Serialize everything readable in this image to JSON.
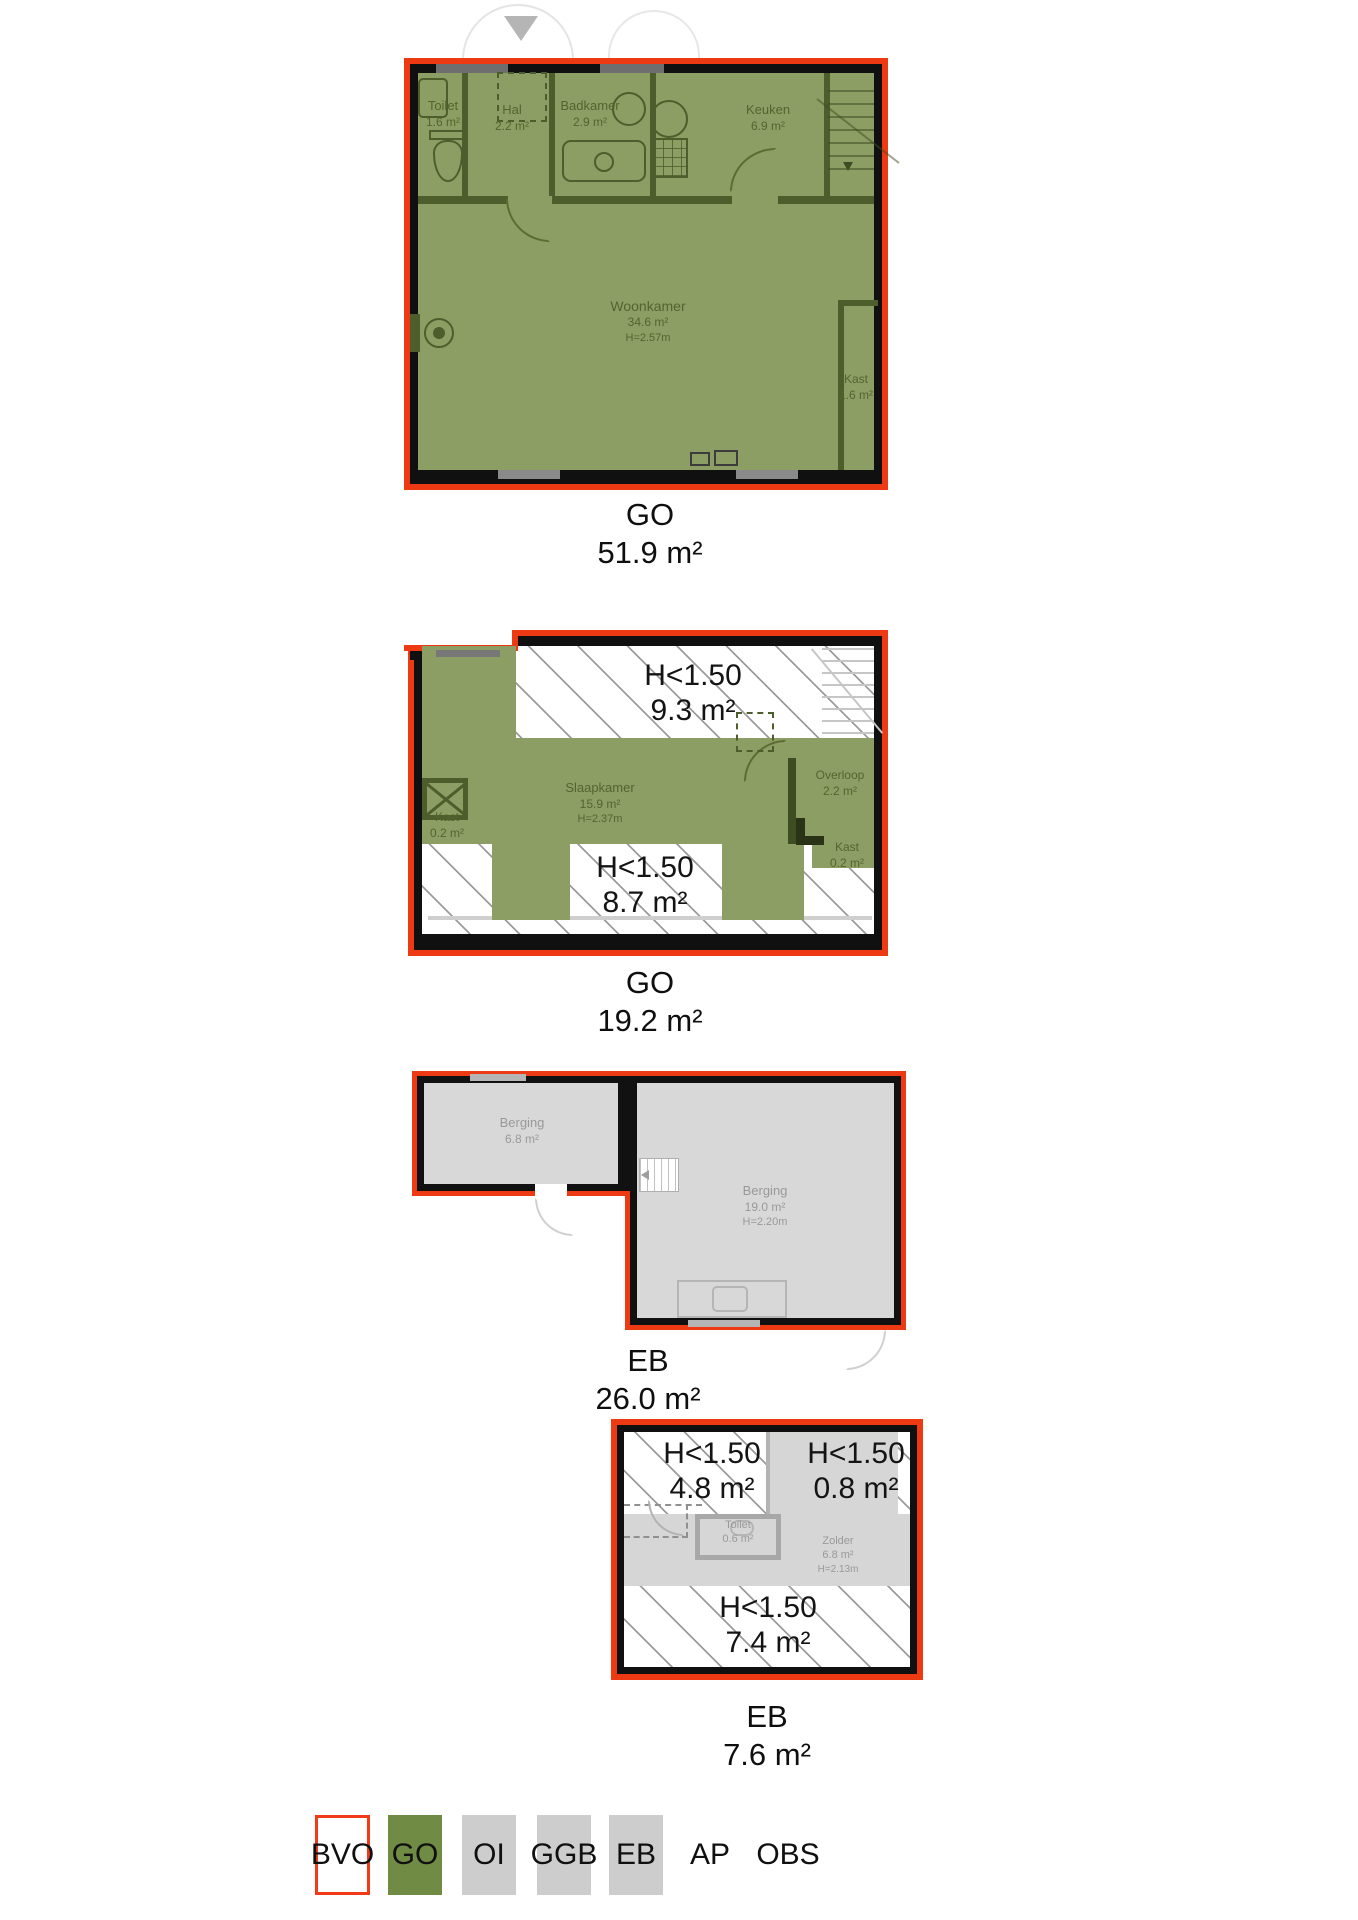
{
  "colors": {
    "outline_red": "#ee3a12",
    "fill_green": "#8c9e63",
    "legend_green": "#6f8b44",
    "fill_gray": "#d6d6d6",
    "legend_gray": "#cdcdcd",
    "wall_black": "#101010",
    "wall_olive": "#4d5d2c",
    "room_text_olive": "#54642f",
    "room_text_gray": "#999999"
  },
  "plans": [
    {
      "label": "GO",
      "area": "51.9 m²",
      "rooms": {
        "toilet": {
          "name": "Toilet",
          "area": "1.6 m²"
        },
        "hal": {
          "name": "Hal",
          "area": "2.2 m²"
        },
        "badkamer": {
          "name": "Badkamer",
          "area": "2.9 m²"
        },
        "keuken": {
          "name": "Keuken",
          "area": "6.9 m²"
        },
        "woonkamer": {
          "name": "Woonkamer",
          "area": "34.6 m²",
          "height": "H=2.57m"
        },
        "kast": {
          "name": "Kast",
          "area": "1.6 m²"
        }
      }
    },
    {
      "label": "GO",
      "area": "19.2 m²",
      "rooms": {
        "h150_top": {
          "line1": "H<1.50",
          "line2": "9.3 m²"
        },
        "slaapkamer": {
          "name": "Slaapkamer",
          "area": "15.9 m²",
          "height": "H=2.37m"
        },
        "overloop": {
          "name": "Overloop",
          "area": "2.2 m²"
        },
        "kast_left": {
          "name": "Kast",
          "area": "0.2 m²"
        },
        "kast_right": {
          "name": "Kast",
          "area": "0.2 m²"
        },
        "h150_bottom": {
          "line1": "H<1.50",
          "line2": "8.7 m²"
        }
      }
    },
    {
      "label": "EB",
      "area": "26.0 m²",
      "rooms": {
        "berging_small": {
          "name": "Berging",
          "area": "6.8 m²"
        },
        "berging_large": {
          "name": "Berging",
          "area": "19.0 m²",
          "height": "H=2.20m"
        }
      }
    },
    {
      "label": "EB",
      "area": "7.6 m²",
      "rooms": {
        "h150_topleft": {
          "line1": "H<1.50",
          "line2": "4.8 m²"
        },
        "h150_topright": {
          "line1": "H<1.50",
          "line2": "0.8 m²"
        },
        "toilet": {
          "name": "Toilet",
          "area": "0.6 m²"
        },
        "zolder": {
          "name": "Zolder",
          "area": "6.8 m²",
          "height": "H=2.13m"
        },
        "h150_bottom": {
          "line1": "H<1.50",
          "line2": "7.4 m²"
        }
      }
    }
  ],
  "legend": {
    "items": [
      {
        "code": "BVO"
      },
      {
        "code": "GO"
      },
      {
        "code": "OI"
      },
      {
        "code": "GGB"
      },
      {
        "code": "EB"
      },
      {
        "code": "AP"
      },
      {
        "code": "OBS"
      }
    ]
  }
}
